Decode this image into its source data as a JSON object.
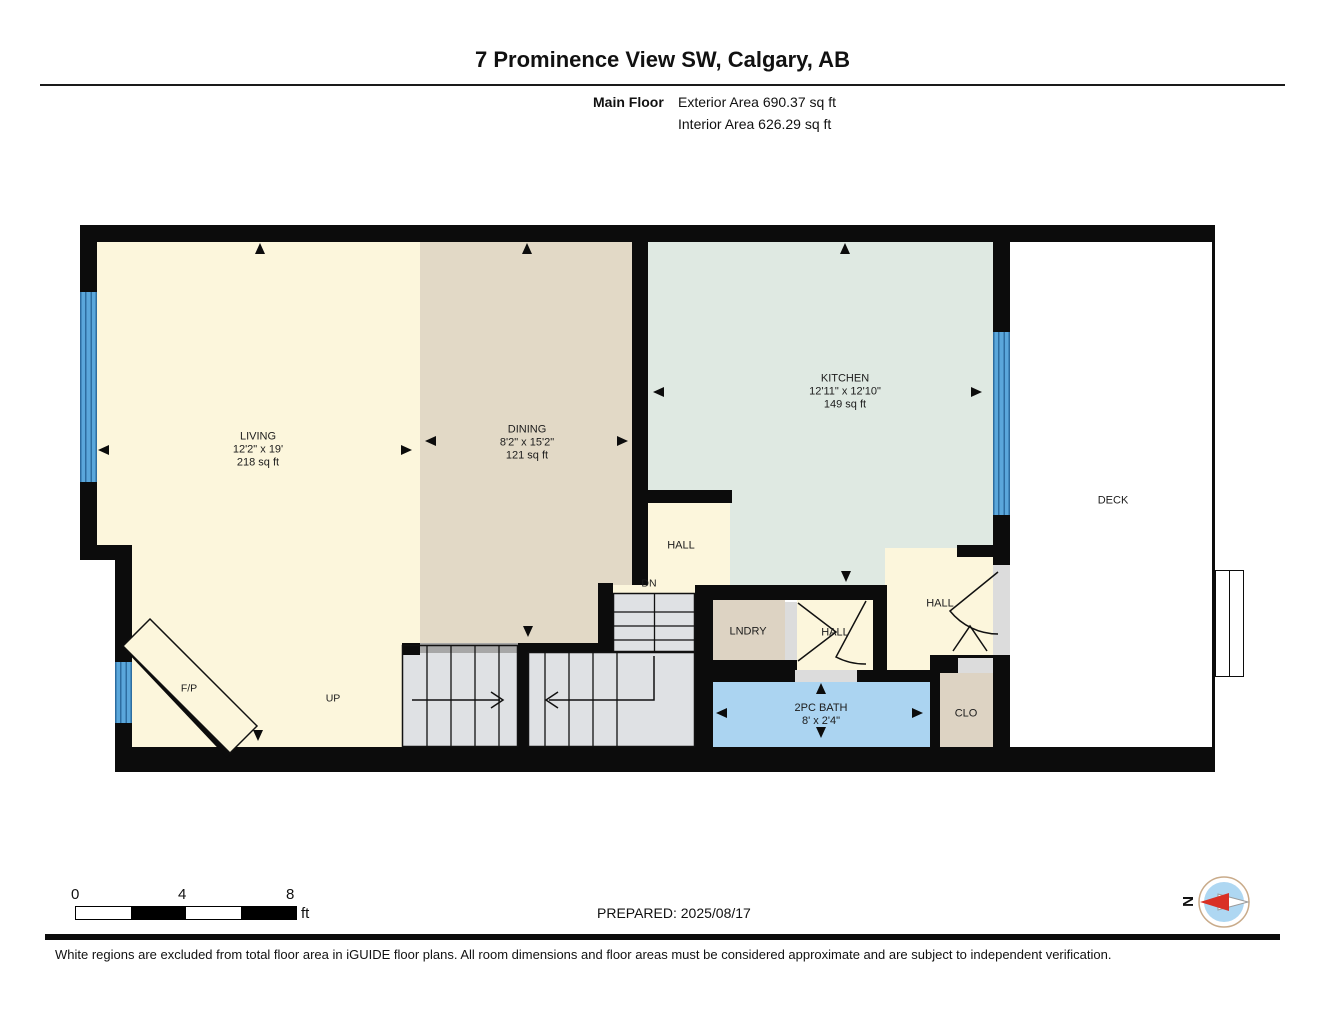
{
  "header": {
    "title": "7 Prominence View SW, Calgary, AB",
    "floor_label": "Main Floor",
    "exterior_area": "Exterior Area 690.37 sq ft",
    "interior_area": "Interior Area 626.29 sq ft"
  },
  "rooms": {
    "living": {
      "name": "LIVING",
      "dims": "12'2\" x 19'",
      "area": "218 sq ft"
    },
    "dining": {
      "name": "DINING",
      "dims": "8'2\" x 15'2\"",
      "area": "121 sq ft"
    },
    "kitchen": {
      "name": "KITCHEN",
      "dims": "12'11\" x 12'10\"",
      "area": "149 sq ft"
    },
    "bath": {
      "name": "2PC BATH",
      "dims": "8' x 2'4\""
    },
    "hall_upper": {
      "name": "HALL"
    },
    "hall_center": {
      "name": "HALL"
    },
    "hall_right": {
      "name": "HALL"
    },
    "laundry": {
      "name": "LNDRY"
    },
    "closet": {
      "name": "CLO"
    },
    "deck": {
      "name": "DECK"
    },
    "fireplace": {
      "name": "F/P"
    },
    "stairs": {
      "up": "UP",
      "down": "DN"
    }
  },
  "scale_bar": {
    "tick_start": "0",
    "tick_mid": "4",
    "tick_end": "8",
    "unit": "ft"
  },
  "prepared": "PREPARED: 2025/08/17",
  "compass": {
    "north_label": "N"
  },
  "disclaimer": "White regions are excluded from total floor area in iGUIDE floor plans. All room dimensions and floor areas must be considered approximate and are subject to independent verification.",
  "colors": {
    "wall": "#0c0c0c",
    "living_floor": "#fcf6dc",
    "dining_floor": "#e2d9c6",
    "kitchen_floor": "#dfe9e2",
    "laundry_floor": "#ddd3c3",
    "bath_floor": "#abd4f1",
    "stair_gray": "#dfe1e4",
    "window_blue": "#5aa7db",
    "compass_disk": "#aed7f2",
    "compass_needle_red": "#d93025"
  }
}
